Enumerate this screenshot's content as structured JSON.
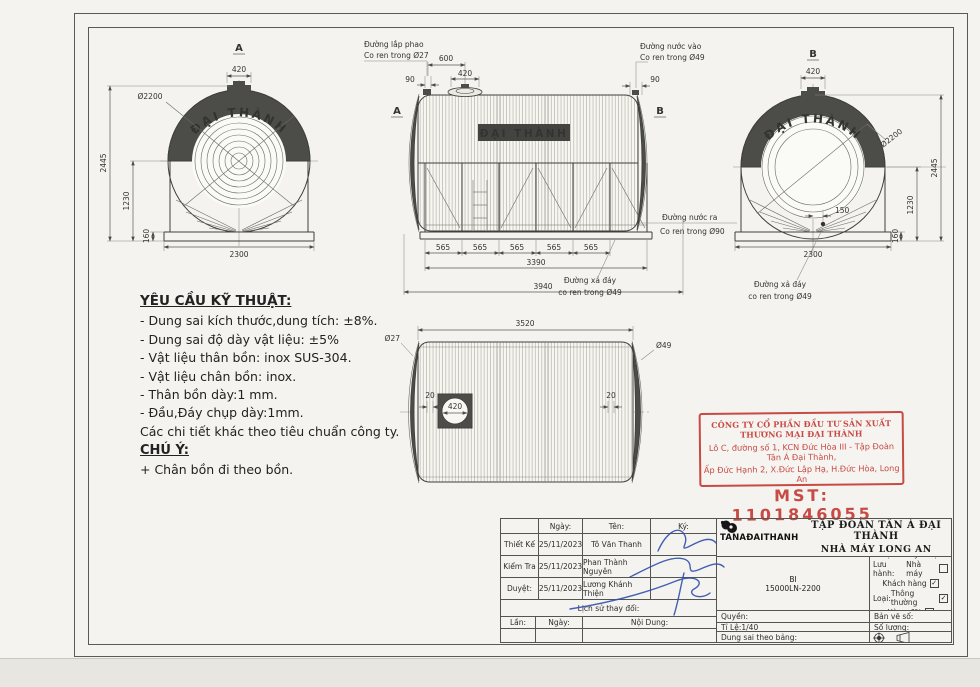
{
  "palette": {
    "paper": "#f4f3ef",
    "line": "#3f3f3b",
    "dark_fill": "#4c4c48",
    "stamp_red": "#c84a44",
    "signature_blue": "#2f4fae"
  },
  "views": {
    "view_a": {
      "label": "A",
      "top_width": "420",
      "diameter": "Ø2200",
      "height_total": "2445",
      "height_center": "1230",
      "base_height": "160",
      "base_width": "2300",
      "brand": "ĐẠI THÀNH"
    },
    "elevation": {
      "label_a": "A",
      "label_b": "B",
      "brand": "ĐẠI THÀNH",
      "float_line1": "Đường lắp phao",
      "float_line2": "Co ren trong Ø27",
      "inlet_line1": "Đường nước vào",
      "inlet_line2": "Co ren trong Ø49",
      "outlet_line1": "Đường nước ra",
      "outlet_line2": "Co ren trong Ø90",
      "drain_line1": "Đường xả đáy",
      "drain_line2": "co ren trong Ø49",
      "d90_left": "90",
      "d600": "600",
      "d420": "420",
      "d90_right": "90",
      "d565": "565",
      "d3390": "3390",
      "d3940": "3940"
    },
    "view_b": {
      "label": "B",
      "top_width": "420",
      "diameter": "Ø2200",
      "height_total": "2445",
      "height_center": "1230",
      "base_height": "160",
      "base_width": "2300",
      "offset_drain": "150",
      "drain_line1": "Đường xả đáy",
      "drain_line2": "co ren trong Ø49",
      "brand": "ĐẠI THÀNH"
    },
    "top_view": {
      "length": "3520",
      "left_pipe": "Ø27",
      "right_pipe": "Ø49",
      "offset_left": "20",
      "offset_right": "20",
      "manhole": "420"
    }
  },
  "notes": {
    "title": "YÊU CẦU KỸ THUẬT:",
    "lines": [
      "- Dung sai kích thước,dung tích: ±8%.",
      "- Dung sai độ dày vật liệu: ±5%",
      "- Vật liệu thân bồn: inox SUS-304.",
      "- Vật liệu chân bồn: inox.",
      "- Thân bồn dày:1 mm.",
      "- Đầu,Đáy chụp dày:1mm.",
      "Các chi tiết khác theo tiêu chuẩn công ty."
    ],
    "chu_y": "CHÚ Ý:",
    "chu_y_line": "+ Chân bồn đi theo bồn."
  },
  "stamp": {
    "line1": "CÔNG TY CỔ PHẦN ĐẦU TƯ SẢN XUẤT THƯƠNG MẠI ĐẠI THÀNH",
    "line2": "Lô C, đường số 1, KCN Đức Hòa III - Tập Đoàn Tân Á Đại Thành,",
    "line3": "Ấp Đức Hạnh 2, X.Đức Lập Hạ, H.Đức Hòa, Long An",
    "mst": "MST: 1101846055"
  },
  "titleblock": {
    "col_ngay": "Ngày:",
    "col_ten": "Tên:",
    "col_ky": "Ký:",
    "rows": [
      {
        "role": "Thiết Kế",
        "date": "25/11/2023",
        "name": "Tô Văn Thanh"
      },
      {
        "role": "Kiểm Tra",
        "date": "25/11/2023",
        "name": "Phan Thành Nguyên"
      },
      {
        "role": "Duyệt:",
        "date": "25/11/2023",
        "name": "Lương Khánh Thiện"
      }
    ],
    "history": "Lịch sử thay đổi:",
    "lan": "Lần:",
    "ngay2": "Ngày:",
    "noidung": "Nội Dung:",
    "logo_text": "TANAĐAITHANH",
    "company1": "TẬP ĐOÀN TÂN Á ĐẠI THÀNH",
    "company2": "NHÀ MÁY LONG AN",
    "model1": "BI",
    "model2": "15000LN-2200",
    "scope": {
      "title": "Phạm vi kỹ thuật:",
      "rows": [
        {
          "prefix": "Lưu hành:",
          "label": "Nhà máy",
          "check": ""
        },
        {
          "prefix": "",
          "label": "Khách hàng",
          "check": "✓"
        },
        {
          "prefix": "Loại:",
          "label": "Thông thường",
          "check": "✓"
        },
        {
          "prefix": "",
          "label": "Hàng đặt",
          "check": ""
        }
      ]
    },
    "quyen": "Quyền:",
    "tile": "Tỉ Lệ:1/40",
    "dungsai": "Dung sai theo bảng:",
    "banveso": "Bản vẽ số:",
    "soluong": "Số lượng:"
  }
}
